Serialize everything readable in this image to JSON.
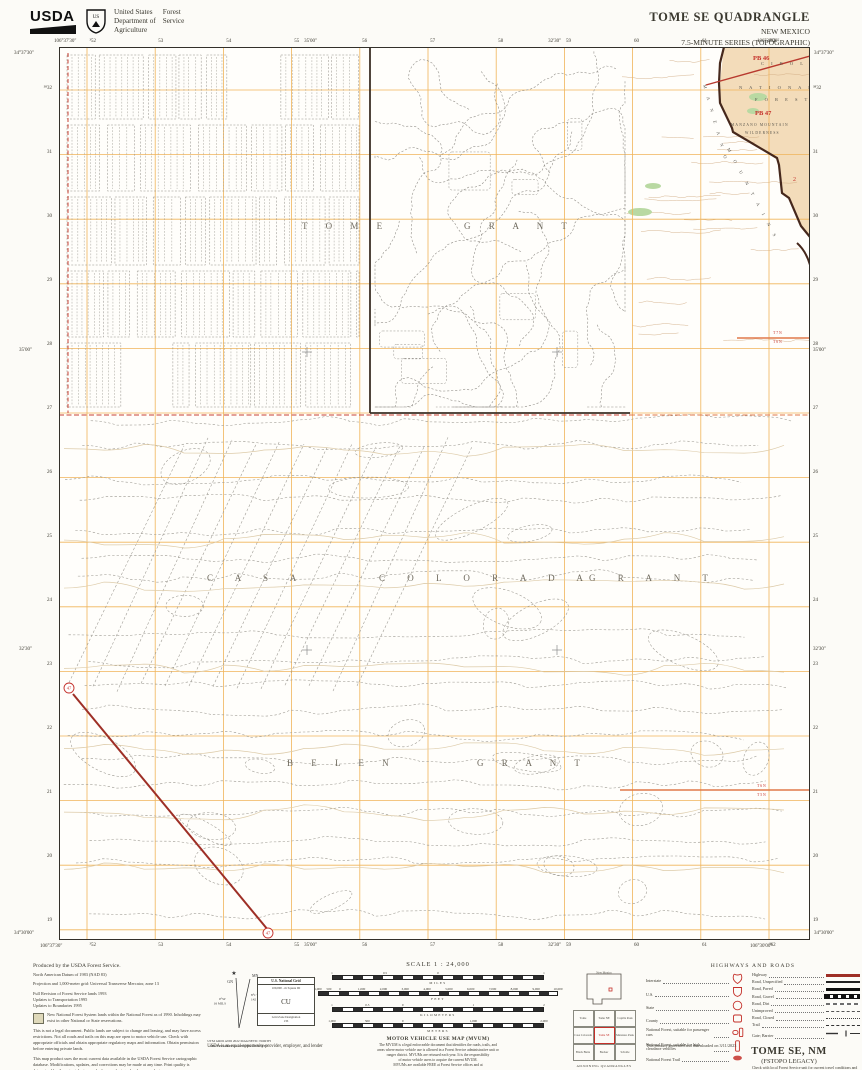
{
  "header": {
    "usda": "USDA",
    "dept": [
      "United States",
      "Department of",
      "Agriculture"
    ],
    "service": [
      "Forest",
      "Service"
    ],
    "shield_text": "US"
  },
  "title_block": {
    "title": "TOME SE QUADRANGLE",
    "state": "NEW MEXICO",
    "series": "7.5-MINUTE SERIES (TOPOGRAPHIC)"
  },
  "map": {
    "corners": {
      "top_left_lon": "106°37'30\"",
      "top_left_lat": "34°37'30\"",
      "top_right_lon": "106°30'00\"",
      "top_right_lat": "34°37'30\"",
      "bottom_left_lon": "106°37'30\"",
      "bottom_left_lat": "34°30'00\"",
      "bottom_right_lon": "106°30'00\"",
      "bottom_right_lat": "34°30'00\""
    },
    "top_numbers": [
      "³52",
      "53",
      "54",
      "55",
      "56",
      "57",
      "58",
      "59",
      "60",
      "61",
      "³62"
    ],
    "bottom_numbers": [
      "³52",
      "53",
      "54",
      "55",
      "56",
      "57",
      "58",
      "59",
      "60",
      "61",
      "³62"
    ],
    "left_numbers": [
      "³⁸32",
      "31",
      "30",
      "29",
      "28",
      "27",
      "26",
      "25",
      "24",
      "23",
      "22",
      "21",
      "20",
      "19"
    ],
    "right_numbers": [
      "³⁸32",
      "31",
      "30",
      "29",
      "28",
      "27",
      "26",
      "25",
      "24",
      "23",
      "22",
      "21",
      "20",
      "19"
    ],
    "lon_ticks": [
      {
        "text": "35'00\"",
        "f": 0.335
      },
      {
        "text": "32'30\"",
        "f": 0.66
      }
    ],
    "lat_ticks": [
      {
        "text": "35'00\"",
        "f": 0.34
      },
      {
        "text": "32'30\"",
        "f": 0.675
      }
    ],
    "labels": [
      {
        "t": "T   O   M   E",
        "x": 243,
        "y": 182,
        "s": 9,
        "ls": 8,
        "c": "#6f6a5e"
      },
      {
        "t": "G   R   A   N   T",
        "x": 405,
        "y": 182,
        "s": 9,
        "ls": 8,
        "c": "#6f6a5e"
      },
      {
        "t": "C   A   S   A",
        "x": 148,
        "y": 534,
        "s": 9,
        "ls": 10,
        "c": "#6f6a5e"
      },
      {
        "t": "C   O   L   O   R   A   D   A",
        "x": 320,
        "y": 534,
        "s": 9,
        "ls": 10,
        "c": "#6f6a5e"
      },
      {
        "t": "G   R   A   N   T",
        "x": 530,
        "y": 534,
        "s": 9,
        "ls": 10,
        "c": "#6f6a5e"
      },
      {
        "t": "B   E   L   E   N",
        "x": 228,
        "y": 719,
        "s": 9,
        "ls": 8,
        "c": "#6f6a5e"
      },
      {
        "t": "G   R   A   N   T",
        "x": 418,
        "y": 719,
        "s": 9,
        "ls": 8,
        "c": "#6f6a5e"
      },
      {
        "t": "C I B O L A",
        "x": 702,
        "y": 18,
        "s": 4.5,
        "ls": 3,
        "c": "#55524a"
      },
      {
        "t": "N A T I O N A L",
        "x": 680,
        "y": 42,
        "s": 4.5,
        "ls": 3,
        "c": "#55524a"
      },
      {
        "t": "F O R E S T",
        "x": 696,
        "y": 54,
        "s": 4.5,
        "ls": 3,
        "c": "#55524a"
      },
      {
        "t": "PB 46",
        "x": 694,
        "y": 13,
        "s": 6.5,
        "c": "#c4302a",
        "w": 1
      },
      {
        "t": "PB 47",
        "x": 696,
        "y": 68,
        "s": 6.5,
        "c": "#c4302a",
        "w": 1
      },
      {
        "t": "MANZANO MOUNTAIN",
        "x": 672,
        "y": 79,
        "s": 3.6,
        "ls": 1.2,
        "c": "#55524a"
      },
      {
        "t": "WILDERNESS",
        "x": 686,
        "y": 87,
        "s": 3.6,
        "ls": 1.2,
        "c": "#55524a"
      },
      {
        "t": "M A N Z A N O",
        "x": 644,
        "y": 38,
        "s": 4.5,
        "ls": 4,
        "c": "#55524a",
        "rot": 74
      },
      {
        "t": "M O U N T A I N S",
        "x": 668,
        "y": 102,
        "s": 4.5,
        "ls": 4,
        "c": "#55524a",
        "rot": 62
      },
      {
        "t": "T 7 N",
        "x": 714,
        "y": 287,
        "s": 3.8,
        "c": "#c4302a"
      },
      {
        "t": "T 6 N",
        "x": 714,
        "y": 296,
        "s": 3.8,
        "c": "#c4302a"
      },
      {
        "t": "T 6 N",
        "x": 698,
        "y": 740,
        "s": 3.8,
        "c": "#c4302a"
      },
      {
        "t": "T 5 N",
        "x": 698,
        "y": 749,
        "s": 3.8,
        "c": "#c4302a"
      },
      {
        "t": "2",
        "x": 734,
        "y": 134,
        "s": 6,
        "c": "#c4302a"
      }
    ],
    "badges": [
      {
        "text": "47",
        "x": 10,
        "y": 641
      },
      {
        "text": "47",
        "x": 209,
        "y": 886
      }
    ]
  },
  "footer": {
    "notes": {
      "produced": "Produced by the USDA Forest Service.",
      "lines": [
        "North American Datum of 1983 (NAD 83)",
        "Projection and 1,000-meter grid: Universal Transverse Mercator, zone 13"
      ],
      "revision_lines": [
        "Full Revision of Forest Service lands 1993",
        "Updates to Transportation 1995",
        "Updates to Boundaries 1995"
      ],
      "box_note": "New National Forest System lands within the National Forest as of 1990. Inholdings may exist in other National or State reservations.",
      "para1": "This is not a legal document. Public lands are subject to change and leasing, and may have access restrictions. Not all roads and trails on this map are open to motor vehicle use. Check with appropriate officials and obtain appropriate regulatory maps and information. Obtain permission before entering private lands.",
      "para2": "This map product uses the most current data available in the USDA Forest Service cartographic database. Modifications, updates, and corrections may be made at any time. Print quality is determined by the output device used when producing a hardcopy product."
    },
    "declination": {
      "star": "★",
      "gn": "GN",
      "mn": "MN",
      "gn_angle": "0°52'",
      "gn_mils": "16 MILS",
      "mn_angle": "8°1'",
      "mn_mils": "142 MILS",
      "caption1": "UTM GRID AND 2022 MAGNETIC NORTH",
      "caption2": "DECLINATION AT CENTER OF SHEET"
    },
    "usng": {
      "title": "U.S. National Grid",
      "subtitle": "100,000 - m Square ID",
      "square_id": "CU",
      "footer1": "Grid Zone Designation",
      "footer2": "13S"
    },
    "equal_opportunity": "USDA is an equal opportunity provider, employer, and lender",
    "scale": {
      "title": "SCALE 1 : 24,000",
      "bars": [
        {
          "unit": "MILES",
          "width": 212,
          "labels": [
            [
              "1",
              0
            ],
            [
              "0.5",
              0.25
            ],
            [
              "0",
              0.5
            ],
            [
              "1",
              1
            ]
          ]
        },
        {
          "unit": "FEET",
          "width": 240,
          "labels": [
            [
              "1,000",
              0
            ],
            [
              "500",
              0.0455
            ],
            [
              "0",
              0.0909
            ],
            [
              "1,000",
              0.1818
            ],
            [
              "2,000",
              0.2727
            ],
            [
              "3,000",
              0.3636
            ],
            [
              "4,000",
              0.4545
            ],
            [
              "5,000",
              0.5455
            ],
            [
              "6,000",
              0.6364
            ],
            [
              "7,000",
              0.7273
            ],
            [
              "8,000",
              0.8182
            ],
            [
              "9,000",
              0.9091
            ],
            [
              "10,000",
              1
            ]
          ]
        },
        {
          "unit": "KILOMETERS",
          "width": 212,
          "labels": [
            [
              "1",
              0
            ],
            [
              "0.5",
              0.1667
            ],
            [
              "0",
              0.3333
            ],
            [
              "1",
              0.6667
            ],
            [
              "2",
              1
            ]
          ]
        },
        {
          "unit": "METERS",
          "width": 212,
          "labels": [
            [
              "1,000",
              0
            ],
            [
              "500",
              0.1667
            ],
            [
              "0",
              0.3333
            ],
            [
              "1,000",
              0.6667
            ],
            [
              "2,000",
              1
            ]
          ]
        }
      ]
    },
    "mvum": {
      "title": "MOTOR VEHICLE USE MAP (MVUM)",
      "body": [
        "The MVUM is a legal enforceable document that identifies the roads, trails, and",
        "areas where motor vehicle use is allowed in a Forest Service administrative unit or",
        "ranger district. MVUMs are reissued each year. It is the responsibility",
        "of motor vehicle users to acquire the current MVUM.",
        "MVUMs are available FREE at Forest Service offices and at"
      ],
      "url": "www.fs.fed.us/recreation/programs/ohv/ohv_maps.shtml"
    },
    "adjoining": {
      "state_label": "New Mexico",
      "caption": "ADJOINING QUADRANGLES",
      "quads": [
        "Tome",
        "Tome NE",
        "Capilla Peak",
        "Casa Colorada",
        "Tome SE",
        "Manzano Peak",
        "Black Butte",
        "Becker",
        "Scholle"
      ]
    },
    "legend": {
      "title": "HIGHWAYS AND ROADS",
      "shield_items": [
        {
          "label": "Interstate",
          "icon": "interstate-shield"
        },
        {
          "label": "U.S.",
          "icon": "us-route-shield"
        },
        {
          "label": "State",
          "icon": "state-route-circle"
        },
        {
          "label": "County",
          "icon": "county-route-badge"
        },
        {
          "label": "National Forest, suitable for passenger cars",
          "icon": "nf-passenger-badge"
        },
        {
          "label": "National Forest, suitable for high clearance vehicles",
          "icon": "nf-high-clearance-badge"
        },
        {
          "label": "National Forest Trail",
          "icon": "nf-trail-badge"
        }
      ],
      "line_items": [
        {
          "label": "Highway",
          "style": "highway"
        },
        {
          "label": "Road, Unspecified",
          "style": "road-unspecified"
        },
        {
          "label": "Road, Paved",
          "style": "road-paved"
        },
        {
          "label": "Road, Gravel",
          "style": "road-gravel"
        },
        {
          "label": "Road, Dirt",
          "style": "road-dirt"
        },
        {
          "label": "Unimproved",
          "style": "unimproved"
        },
        {
          "label": "Road, Closed",
          "style": "road-closed"
        },
        {
          "label": "Trail",
          "style": "trail"
        },
        {
          "label": "Gate; Barrier",
          "style": "gate-barrier"
        }
      ],
      "note": "Check with local Forest Service unit for current travel conditions and restrictions"
    },
    "generated": "This product generated and downloaded on 3/11/2023",
    "sheet_name": "TOME SE, NM",
    "sheet_series": "(FSTOPO LEGACY)"
  },
  "colors": {
    "grid": "#f0b45a",
    "forest_tan": "#f3dcba",
    "boundary_dark": "#46281c",
    "red": "#c4302a",
    "highway": "#9e2f26",
    "green": "#b9d9a2",
    "contour_sepia": "#ddcba9"
  }
}
